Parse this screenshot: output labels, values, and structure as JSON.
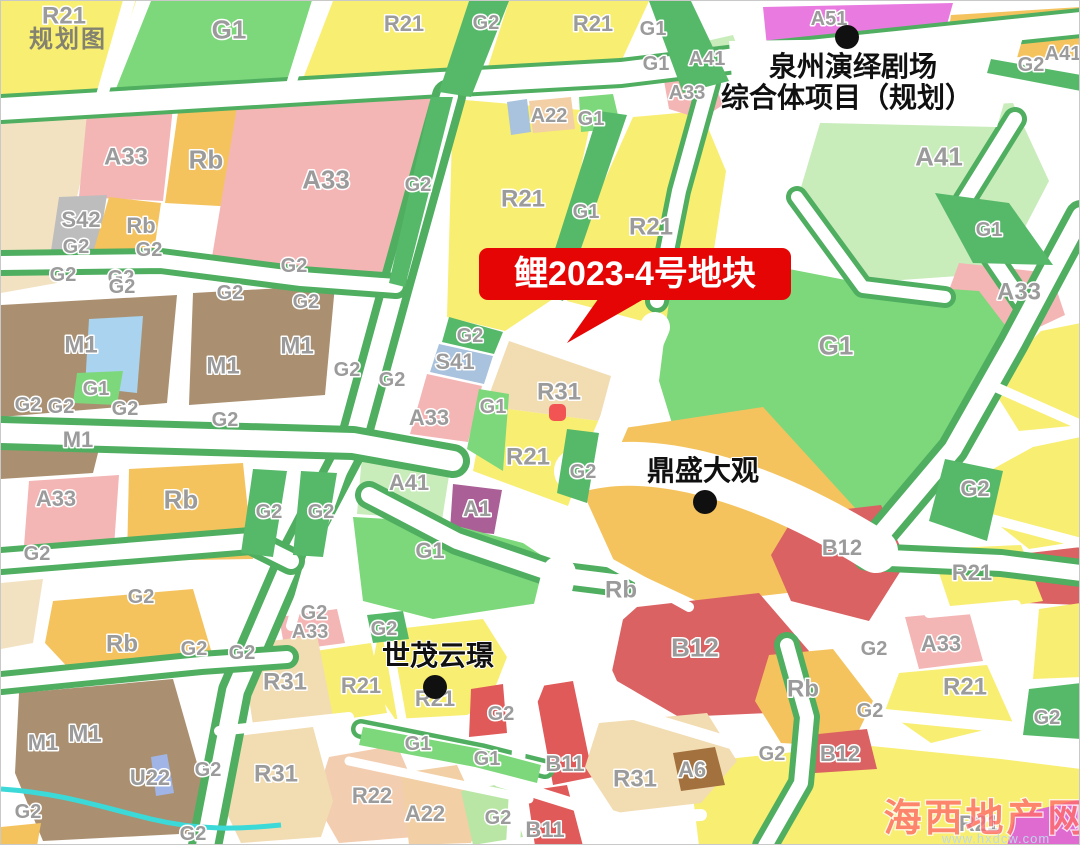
{
  "map": {
    "watermark_topleft": "规划图",
    "watermark_site": {
      "name": "海西地产网",
      "url": "www.hxdcw.com"
    },
    "callout": {
      "label": "鲤2023-4号地块"
    },
    "pois": {
      "theater": {
        "line1": "泉州演绎剧场",
        "line2": "综合体项目（规划）"
      },
      "dingsheng": {
        "name": "鼎盛大观"
      },
      "shimao": {
        "name": "世茂云璟"
      }
    },
    "parcel": {
      "zones": [
        "R31",
        "R21"
      ]
    },
    "palette": {
      "R21": "#f8ee72",
      "R31": "#f2dcb2",
      "R22": "#f3cdb0",
      "A22": "#f2cfa4",
      "G1": "#7cd87a",
      "G2": "#56b96a",
      "G2L": "#b9e6a5",
      "A33": "#f4b5b5",
      "Rb": "#f4c35e",
      "M1": "#aa9070",
      "S41": "#a9c2dd",
      "S42": "#bdbdbd",
      "A41": "#c8ecba",
      "A51": "#e97ae0",
      "A1": "#aa5f96",
      "B12": "#da6262",
      "B11": "#e05a5a",
      "A6": "#a3713d",
      "U22": "#a0b5e6",
      "CREAM": "#f2e2c2",
      "BLUE": "#a9d3ee",
      "MAGENTA": "#e06bd0",
      "WATER": "#3cd9d9",
      "road_white": "#ffffff",
      "road_green": "#4fae60",
      "accent_red": "#e60505",
      "parcel_stroke": "#ee1111",
      "label_gray": "#9b9b9b",
      "poi_black": "#101010"
    },
    "zone_labels": [
      {
        "t": "R21",
        "x": 63,
        "y": 14,
        "s": 24
      },
      {
        "t": "G1",
        "x": 228,
        "y": 28,
        "s": 26
      },
      {
        "t": "R21",
        "x": 403,
        "y": 22,
        "s": 22
      },
      {
        "t": "G2",
        "x": 485,
        "y": 21
      },
      {
        "t": "R21",
        "x": 592,
        "y": 22,
        "s": 22
      },
      {
        "t": "G1",
        "x": 652,
        "y": 27
      },
      {
        "t": "G1",
        "x": 655,
        "y": 62
      },
      {
        "t": "A51",
        "x": 828,
        "y": 17
      },
      {
        "t": "A41",
        "x": 706,
        "y": 57
      },
      {
        "t": "A33",
        "x": 686,
        "y": 91
      },
      {
        "t": "G2",
        "x": 1030,
        "y": 63
      },
      {
        "t": "A41",
        "x": 1062,
        "y": 52
      },
      {
        "t": "A33",
        "x": 125,
        "y": 155,
        "s": 24
      },
      {
        "t": "Rb",
        "x": 205,
        "y": 158,
        "s": 26
      },
      {
        "t": "A33",
        "x": 325,
        "y": 178,
        "s": 26
      },
      {
        "t": "G2",
        "x": 417,
        "y": 183
      },
      {
        "t": "S42",
        "x": 80,
        "y": 218,
        "s": 22
      },
      {
        "t": "Rb",
        "x": 140,
        "y": 224,
        "s": 22
      },
      {
        "t": "G2",
        "x": 75,
        "y": 245
      },
      {
        "t": "G2",
        "x": 148,
        "y": 248
      },
      {
        "t": "G2",
        "x": 293,
        "y": 264
      },
      {
        "t": "G2",
        "x": 62,
        "y": 273
      },
      {
        "t": "G2",
        "x": 120,
        "y": 276
      },
      {
        "t": "A22",
        "x": 548,
        "y": 114
      },
      {
        "t": "G1",
        "x": 590,
        "y": 117
      },
      {
        "t": "R21",
        "x": 522,
        "y": 197,
        "s": 24
      },
      {
        "t": "G1",
        "x": 585,
        "y": 210
      },
      {
        "t": "R21",
        "x": 650,
        "y": 225,
        "s": 24
      },
      {
        "t": "A41",
        "x": 938,
        "y": 155,
        "s": 26
      },
      {
        "t": "G1",
        "x": 988,
        "y": 228
      },
      {
        "t": "A33",
        "x": 1018,
        "y": 290,
        "s": 24
      },
      {
        "t": "G2",
        "x": 121,
        "y": 285
      },
      {
        "t": "G2",
        "x": 229,
        "y": 291
      },
      {
        "t": "G2",
        "x": 305,
        "y": 300
      },
      {
        "t": "M1",
        "x": 80,
        "y": 343,
        "s": 24
      },
      {
        "t": "M1",
        "x": 222,
        "y": 364,
        "s": 24
      },
      {
        "t": "M1",
        "x": 296,
        "y": 344,
        "s": 24
      },
      {
        "t": "G1",
        "x": 95,
        "y": 387
      },
      {
        "t": "G2",
        "x": 27,
        "y": 403
      },
      {
        "t": "G2",
        "x": 60,
        "y": 405
      },
      {
        "t": "G2",
        "x": 124,
        "y": 407
      },
      {
        "t": "G2",
        "x": 224,
        "y": 418
      },
      {
        "t": "G2",
        "x": 346,
        "y": 368
      },
      {
        "t": "M1",
        "x": 77,
        "y": 438,
        "s": 22
      },
      {
        "t": "A33",
        "x": 55,
        "y": 497,
        "s": 22
      },
      {
        "t": "Rb",
        "x": 180,
        "y": 498,
        "s": 26
      },
      {
        "t": "G2",
        "x": 268,
        "y": 510
      },
      {
        "t": "G2",
        "x": 320,
        "y": 510
      },
      {
        "t": "G2",
        "x": 36,
        "y": 552
      },
      {
        "t": "G2",
        "x": 469,
        "y": 334
      },
      {
        "t": "S41",
        "x": 454,
        "y": 360,
        "s": 22
      },
      {
        "t": "G2",
        "x": 391,
        "y": 378
      },
      {
        "t": "A33",
        "x": 428,
        "y": 416,
        "s": 22
      },
      {
        "t": "G1",
        "x": 492,
        "y": 405
      },
      {
        "t": "R31",
        "x": 558,
        "y": 390,
        "s": 24
      },
      {
        "t": "R21",
        "x": 527,
        "y": 455,
        "s": 24
      },
      {
        "t": "G2",
        "x": 582,
        "y": 470
      },
      {
        "t": "A41",
        "x": 408,
        "y": 481,
        "s": 22
      },
      {
        "t": "A1",
        "x": 476,
        "y": 507,
        "s": 22
      },
      {
        "t": "G1",
        "x": 429,
        "y": 549,
        "s": 22
      },
      {
        "t": "G1",
        "x": 835,
        "y": 344,
        "s": 26
      },
      {
        "t": "G2",
        "x": 974,
        "y": 487,
        "s": 22
      },
      {
        "t": "B12",
        "x": 841,
        "y": 546,
        "s": 22
      },
      {
        "t": "R21",
        "x": 971,
        "y": 571,
        "s": 22
      },
      {
        "t": "Rb",
        "x": 620,
        "y": 588,
        "s": 24
      },
      {
        "t": "B12",
        "x": 694,
        "y": 646,
        "s": 26
      },
      {
        "t": "Rb",
        "x": 802,
        "y": 687,
        "s": 24
      },
      {
        "t": "A33",
        "x": 940,
        "y": 642,
        "s": 22
      },
      {
        "t": "R21",
        "x": 964,
        "y": 685,
        "s": 24
      },
      {
        "t": "G2",
        "x": 873,
        "y": 647
      },
      {
        "t": "G2",
        "x": 869,
        "y": 709
      },
      {
        "t": "G2",
        "x": 1046,
        "y": 716
      },
      {
        "t": "G2",
        "x": 771,
        "y": 752
      },
      {
        "t": "B12",
        "x": 839,
        "y": 752,
        "s": 22
      },
      {
        "t": "R21",
        "x": 978,
        "y": 822,
        "s": 22
      },
      {
        "t": "G2",
        "x": 140,
        "y": 595
      },
      {
        "t": "Rb",
        "x": 121,
        "y": 642,
        "s": 24
      },
      {
        "t": "G2",
        "x": 193,
        "y": 647
      },
      {
        "t": "G2",
        "x": 241,
        "y": 651
      },
      {
        "t": "G2",
        "x": 313,
        "y": 611
      },
      {
        "t": "A33",
        "x": 309,
        "y": 630
      },
      {
        "t": "R31",
        "x": 284,
        "y": 680,
        "s": 24
      },
      {
        "t": "R21",
        "x": 360,
        "y": 684,
        "s": 22
      },
      {
        "t": "R31",
        "x": 275,
        "y": 772,
        "s": 24
      },
      {
        "t": "M1",
        "x": 42,
        "y": 741,
        "s": 22
      },
      {
        "t": "M1",
        "x": 84,
        "y": 732,
        "s": 24
      },
      {
        "t": "U22",
        "x": 149,
        "y": 776,
        "s": 22
      },
      {
        "t": "G2",
        "x": 207,
        "y": 768
      },
      {
        "t": "G2",
        "x": 27,
        "y": 810
      },
      {
        "t": "G2",
        "x": 192,
        "y": 832
      },
      {
        "t": "G2",
        "x": 383,
        "y": 627
      },
      {
        "t": "R21",
        "x": 434,
        "y": 697,
        "s": 22
      },
      {
        "t": "G2",
        "x": 500,
        "y": 712
      },
      {
        "t": "G1",
        "x": 417,
        "y": 742
      },
      {
        "t": "G1",
        "x": 486,
        "y": 757
      },
      {
        "t": "R22",
        "x": 371,
        "y": 794,
        "s": 22
      },
      {
        "t": "A22",
        "x": 424,
        "y": 812,
        "s": 22
      },
      {
        "t": "G2",
        "x": 497,
        "y": 816
      },
      {
        "t": "B11",
        "x": 564,
        "y": 762,
        "s": 22
      },
      {
        "t": "B11",
        "x": 544,
        "y": 828,
        "s": 22
      },
      {
        "t": "R31",
        "x": 634,
        "y": 777,
        "s": 24
      },
      {
        "t": "A6",
        "x": 691,
        "y": 768,
        "s": 22
      }
    ]
  }
}
